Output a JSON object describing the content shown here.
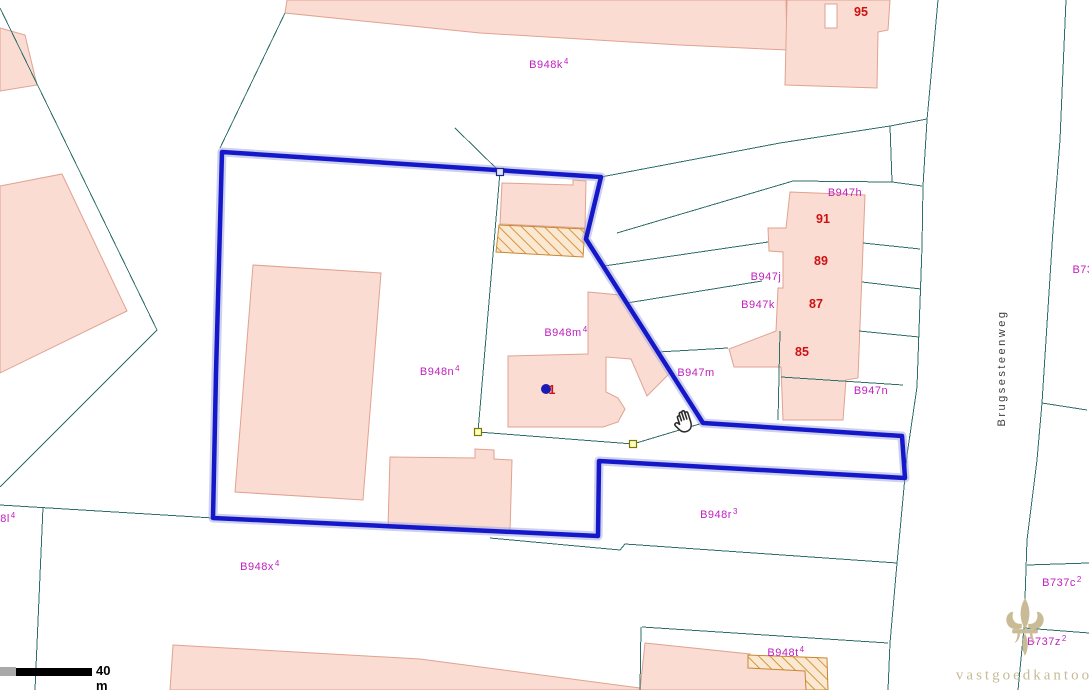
{
  "map": {
    "size": {
      "w": 1089,
      "h": 690
    },
    "colors": {
      "background": "#FFFFFF",
      "parcel_line": "#2E6E69",
      "building_fill": "#FADCD3",
      "building_stroke": "#E0A291",
      "hatch_line": "#D89445",
      "selection_blue": "#1518C8",
      "label_magenta": "#C01EC0",
      "house_number_red": "#CC1111",
      "watermark_beige": "#C7BA95"
    },
    "buildings": [
      {
        "points": "0,28 25,35 37,85 0,91"
      },
      {
        "points": "0,186 62,174 127,311 0,373"
      },
      {
        "points": "287,0 786,0 787,50 680,45 480,33 285,13"
      },
      {
        "points": "787,0 890,0 888,30 878,32 877,88 785,85"
      },
      {
        "points": "790,192 865,195 858,378 846,380 843,420 783,420 781,367 734,367 729,349 776,331 778,288 783,288 783,252 769,251 768,228 786,228"
      },
      {
        "points": "588,292 620,295 672,371 647,396 631,359 606,357 606,392 618,398 625,409 618,422 603,427 508,427 508,356 588,354"
      },
      {
        "points": "390,457 475,458 475,449 494,450 494,459 512,460 510,533 388,528"
      },
      {
        "points": "502,183 573,185 573,180 586,181 585,228 500,224"
      },
      {
        "points": "253,265 381,273 363,500 235,492"
      },
      {
        "points": "173,645 420,659 640,688 640,690 170,690"
      },
      {
        "points": "645,643 750,654 750,667 807,670 809,690 640,690"
      }
    ],
    "holes": [
      {
        "points": "825,4 837,4 837,28 825,28"
      }
    ],
    "hatched": [
      {
        "points": "499,225 585,229 583,257 496,252"
      },
      {
        "points": "748,655 827,658 828,690 806,690 805,671 748,668"
      }
    ],
    "lines": [
      {
        "points": "0,8 157,330 0,487"
      },
      {
        "points": "0,505 213,518"
      },
      {
        "points": "43,507 35,690"
      },
      {
        "points": "285,13 220,148"
      },
      {
        "points": "455,128 500,172"
      },
      {
        "points": "500,172 478,432"
      },
      {
        "points": "478,432 633,444 703,423"
      },
      {
        "points": "490,538 620,550 625,544 897,563"
      },
      {
        "points": "642,627 888,643"
      },
      {
        "points": "641,627 640,690"
      },
      {
        "points": "938,0 927,120 923,186 922,247 917,387 907,455 897,563 890,643 888,690"
      },
      {
        "points": "1066,0 1060,140 1053,230 1042,403 1037,460 1027,540 1024,628 1018,690"
      },
      {
        "points": "1042,403 1087,410"
      },
      {
        "points": "1027,565 1089,563"
      },
      {
        "points": "1024,628 1089,633"
      },
      {
        "points": "601,177 780,143 890,126 927,119"
      },
      {
        "points": "890,126 892,182"
      },
      {
        "points": "617,233 793,181 892,182 922,186"
      },
      {
        "points": "604,266 768,242"
      },
      {
        "points": "863,243 920,249"
      },
      {
        "points": "627,303 762,281"
      },
      {
        "points": "862,282 921,289"
      },
      {
        "points": "658,352 728,348"
      },
      {
        "points": "859,331 919,337"
      },
      {
        "points": "781,377 903,385"
      },
      {
        "points": "780,331 778,420"
      }
    ],
    "selection": {
      "points": "222,152 601,177 586,239 703,423 902,436 905,478 599,461 598,536 213,518 216,373",
      "handles": [
        {
          "x": 500,
          "y": 172,
          "fill": "#DDE6FF",
          "stroke": "#222288"
        },
        {
          "x": 478,
          "y": 432,
          "fill": "#FFFFC0",
          "stroke": "#7A7A00"
        },
        {
          "x": 633,
          "y": 444,
          "fill": "#FFFFC0",
          "stroke": "#7A7A00"
        }
      ]
    },
    "marker": {
      "x": 546,
      "y": 389,
      "r": 5,
      "color": "#1A1AB4"
    },
    "labels": [
      {
        "text": "B948k",
        "sup": "4",
        "x": 549,
        "y": 64,
        "kind": "parcel"
      },
      {
        "text": "95",
        "x": 861,
        "y": 12,
        "kind": "house"
      },
      {
        "text": "B947h",
        "x": 845,
        "y": 193,
        "kind": "parcel"
      },
      {
        "text": "91",
        "x": 823,
        "y": 219,
        "kind": "house"
      },
      {
        "text": "89",
        "x": 821,
        "y": 261,
        "kind": "house"
      },
      {
        "text": "B947j",
        "x": 766,
        "y": 277,
        "kind": "parcel"
      },
      {
        "text": "B947k",
        "x": 758,
        "y": 305,
        "kind": "parcel"
      },
      {
        "text": "87",
        "x": 816,
        "y": 304,
        "kind": "house"
      },
      {
        "text": "85",
        "x": 802,
        "y": 352,
        "kind": "house"
      },
      {
        "text": "B947m",
        "x": 696,
        "y": 373,
        "kind": "parcel"
      },
      {
        "text": "B947n",
        "x": 871,
        "y": 391,
        "kind": "parcel"
      },
      {
        "text": "B948m",
        "sup": "4",
        "x": 566,
        "y": 332,
        "kind": "parcel"
      },
      {
        "text": "B948n",
        "sup": "4",
        "x": 440,
        "y": 371,
        "kind": "parcel"
      },
      {
        "text": "1",
        "x": 552,
        "y": 390,
        "kind": "house"
      },
      {
        "text": "B948r",
        "sup": "3",
        "x": 719,
        "y": 514,
        "kind": "parcel"
      },
      {
        "text": "B948x",
        "sup": "4",
        "x": 260,
        "y": 566,
        "kind": "parcel"
      },
      {
        "text": "B948t",
        "sup": "4",
        "x": 786,
        "y": 652,
        "kind": "parcel"
      },
      {
        "text": "B737c",
        "sup": "2",
        "x": 1062,
        "y": 582,
        "kind": "parcel"
      },
      {
        "text": "B737z",
        "sup": "2",
        "x": 1047,
        "y": 641,
        "kind": "parcel"
      },
      {
        "text": "B73",
        "x": 1083,
        "y": 270,
        "kind": "parcel"
      },
      {
        "text": "8l",
        "sup": "4",
        "x": 8,
        "y": 518,
        "kind": "parcel"
      }
    ],
    "street": {
      "text": "Brugsesteenweg",
      "x": 1002,
      "y": 368
    },
    "scalebar": {
      "label": "40 m"
    },
    "watermark": {
      "text": "vastgoedkantoor",
      "x": 1028,
      "y": 676
    }
  }
}
